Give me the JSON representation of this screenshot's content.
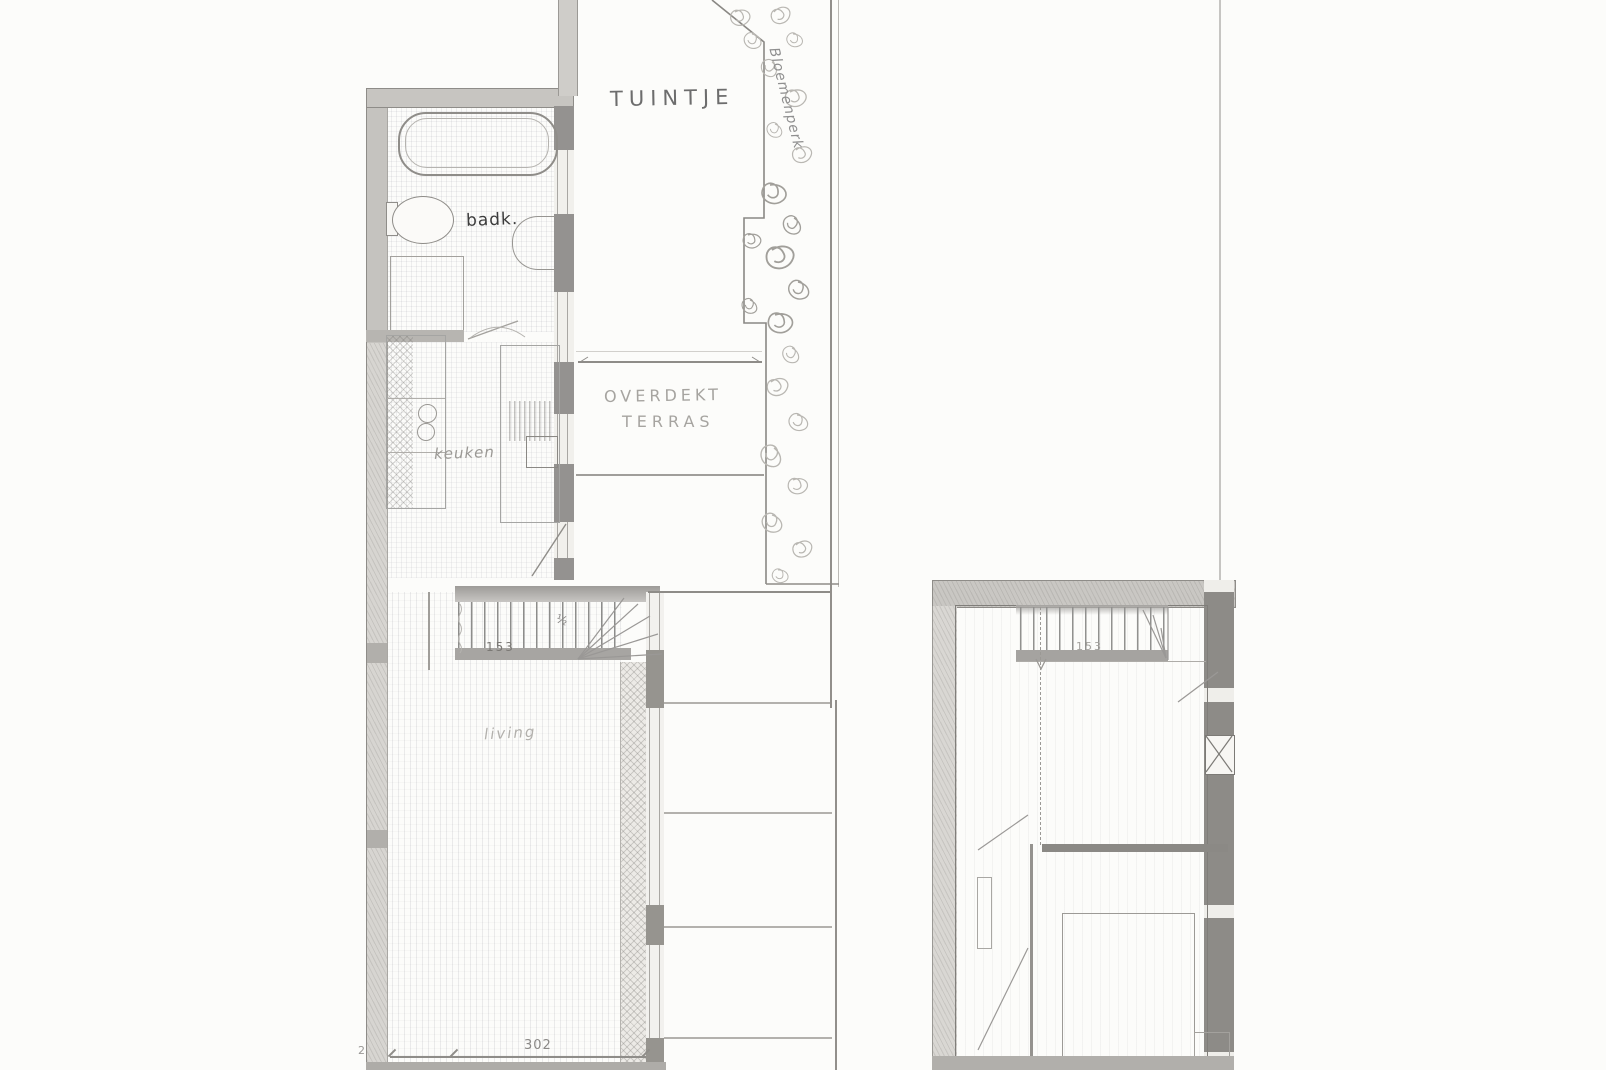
{
  "ground_floor": {
    "garden_label": "TUINTJE",
    "flowerbed_label": "Bloemenperk",
    "terrace_label_line1": "OVERDEKT",
    "terrace_label_line2": "TERRAS",
    "bathroom_label": "badk.",
    "kitchen_label": "keuken",
    "living_label": "living",
    "stair_width_dim": "153",
    "stair_note": "½",
    "living_width_dim": "302",
    "margin_note": "2"
  },
  "upper_floor": {
    "stair_width_dim": "153"
  },
  "colors": {
    "paper": "#fcfcfa",
    "pencil-dark": "#6f6d6a",
    "pencil-mid": "#97958f",
    "pencil-light": "#c6c4c0",
    "wall-fill": "#cbc9c5"
  }
}
